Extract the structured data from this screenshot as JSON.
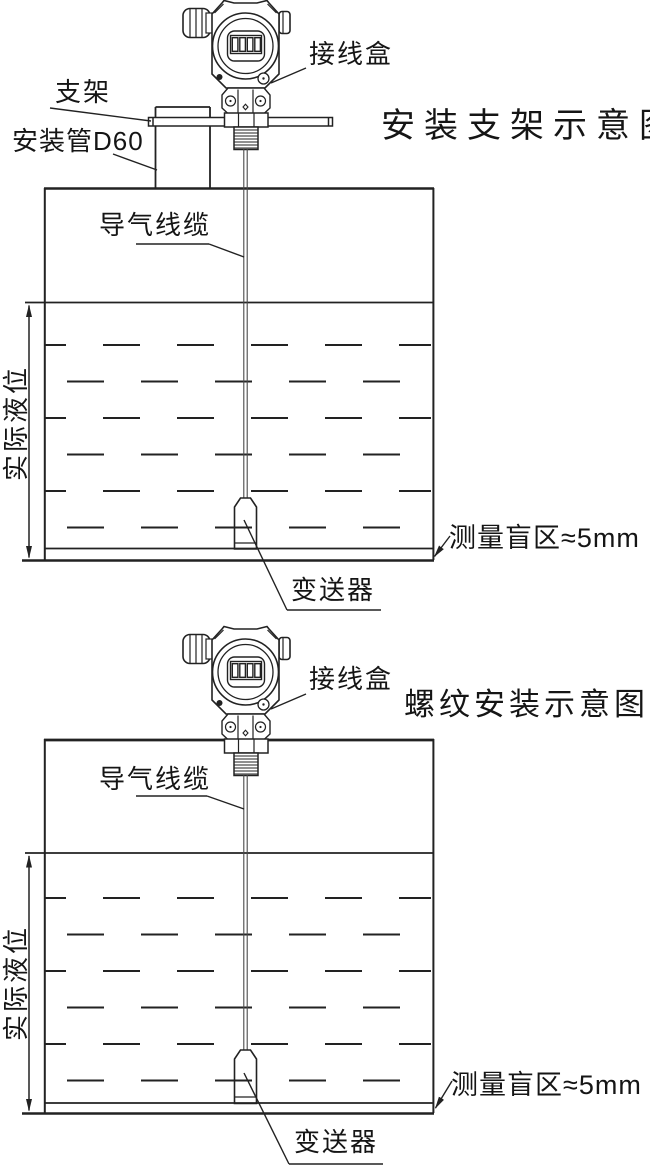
{
  "page": {
    "background": "#ffffff",
    "line_color": "#222222",
    "text_color": "#151515"
  },
  "diagram_top": {
    "title": "安装支架示意图",
    "labels": {
      "junction_box": "接线盒",
      "bracket": "支架",
      "mounting_pipe": "安装管D60",
      "air_cable": "导气线缆",
      "actual_level": "实际液位",
      "blind_zone": "测量盲区≈5mm",
      "transmitter": "变送器"
    },
    "display_cells": 4
  },
  "diagram_bottom": {
    "title": "螺纹安装示意图",
    "labels": {
      "junction_box": "接线盒",
      "air_cable": "导气线缆",
      "actual_level": "实际液位",
      "blind_zone": "测量盲区≈5mm",
      "transmitter": "变送器"
    },
    "display_cells": 4
  }
}
